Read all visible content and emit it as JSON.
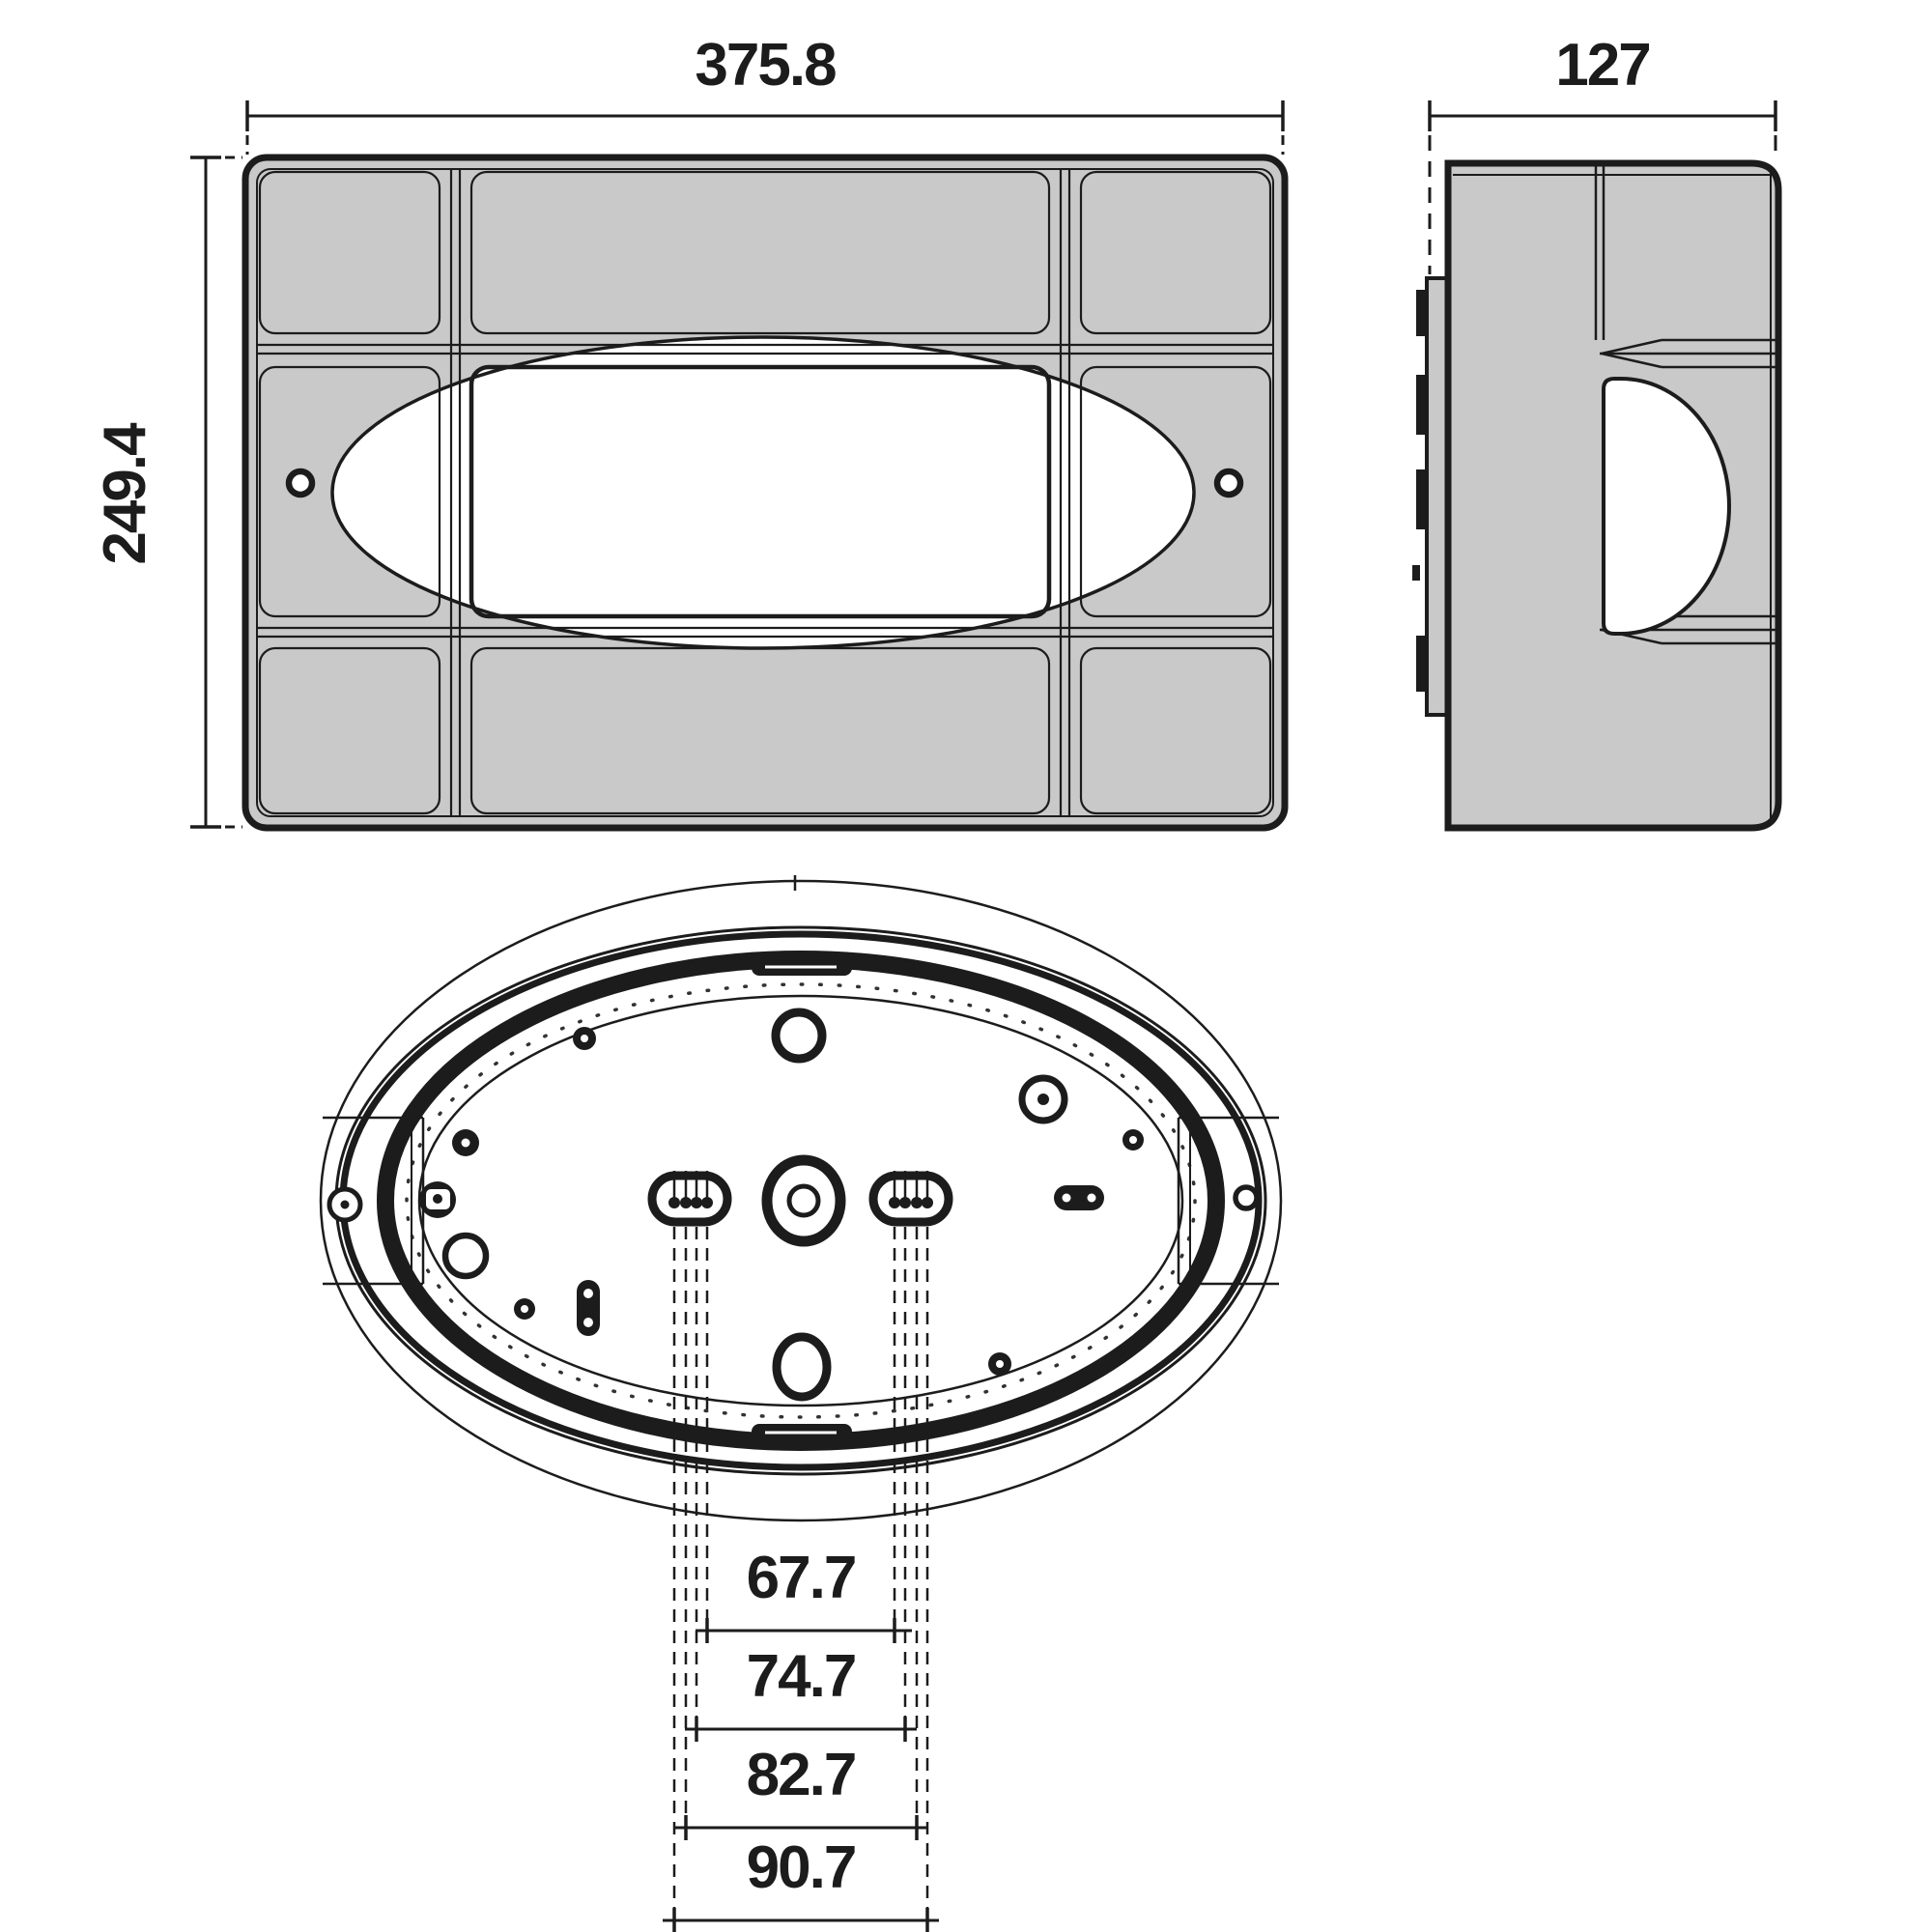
{
  "drawing": {
    "kind": "technical-dimension-drawing",
    "colors": {
      "line": "#1c1c1c",
      "body_fill": "#c9c9c9",
      "background": "#ffffff"
    },
    "views": {
      "front": {
        "width_label": "375.8",
        "height_label": "249.4"
      },
      "side": {
        "depth_label": "127"
      },
      "back": {
        "slot_spacing_labels": [
          "67.7",
          "74.7",
          "82.7",
          "90.7"
        ]
      }
    }
  }
}
